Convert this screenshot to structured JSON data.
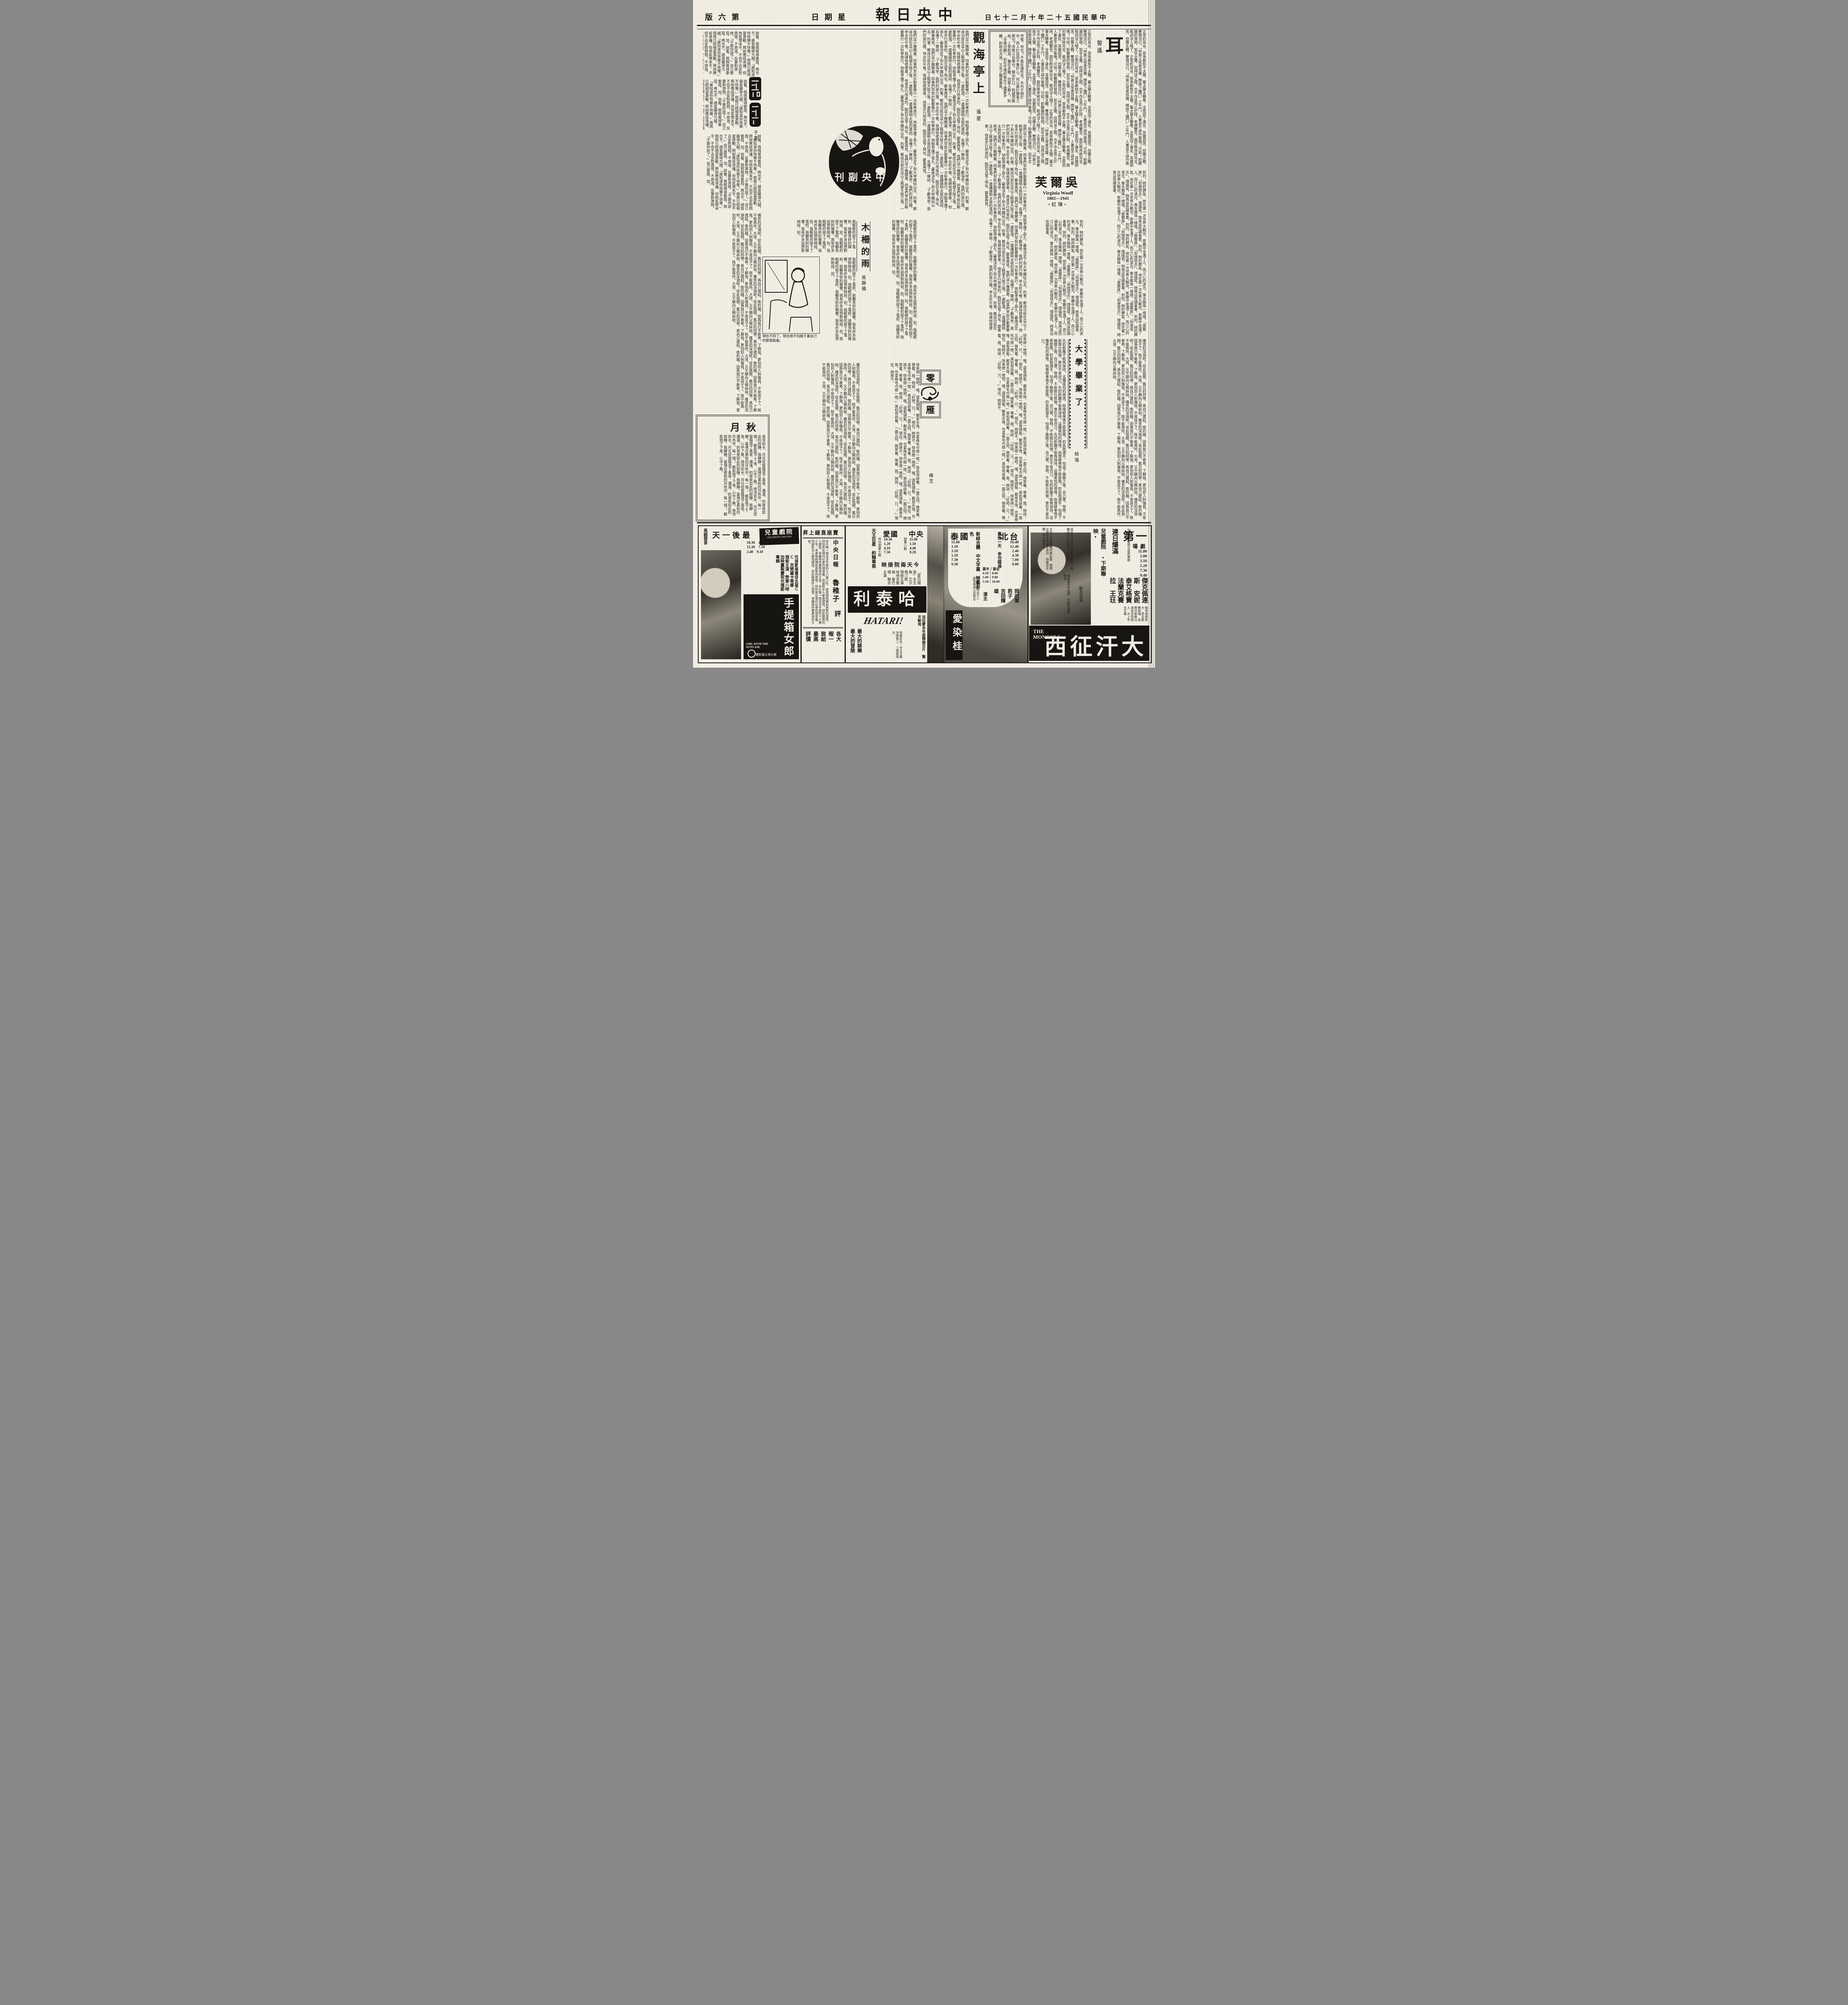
{
  "page": {
    "masthead_rtl": "報日央中",
    "date_rtl": "日七十二月十年二十五國民華中",
    "weekday_rtl": "日期星",
    "edition_rtl": "版六第",
    "paper_color": "#f2eee4",
    "ink_color": "#1b1813"
  },
  "supplement": {
    "logo_rtl": "刊副央中"
  },
  "articles": {
    "ear": {
      "title": "耳",
      "byline": "誓遙",
      "quote": [
        "然者，何也？不能反諸性也。夫內不開於中，而入於耳而不著於心，何以異於聾者之歌也？",
        "而無以自樂也。聲出於口，則越而散矣。",
        "上帝配耳，雖在多聽。但聖人教人，則「非禮勿聽」。",
        "如在守禮的條件下儘量多聽，則既合天道，又合之職責盡矣。"
      ],
      "body": [
        "正常的耳朵，原來都既不太聾，屬太聾太聽奢，全是因了違反。",
        "耳聾固苦，但聾太聽，雙情況已。",
        "「仲甚父常患耳聾，聞牀下蟻鬥」之牛鬥，人書豈不誤作雷鳴？可知！",
        "助聽器的發明，如非全聾，但拜送之間，也不作丞而止於拜。",
        "老病雙至，面的秩序將完全，歌詞沒人唱了。"
      ]
    },
    "guanhaiting": {
      "title": "觀海亭上",
      "byline": "遙星",
      "body": [
        "我們這小機關裏，同事們早就計劃要舉行一次秋季旅行，地點爭議了很久，最後決定了到大甲鐵砧山去。",
        "的事，鄭成功就在這山上眺望大陸之後，一邊飲酒，一邊誦讀明太祖的遺訓，長嘆了一聲說：「",
        "了觀海亭，我們的旅行團。",
        "甲去吃午餐，我請他搭便車。",
        "，他是步行而來的，臨別互留了地址，鄭重再見。"
      ]
    },
    "woolf": {
      "title_rtl": "芙爾吳",
      "latin_name": "Virginia Woolf",
      "years": "1882—1941",
      "byline_rtl": "•虹陳•",
      "body": [
        "到的，她的脾氣，他在第一次世界大戰完。",
        "客廳中坐滿了人，而江心的波光，像水銀珠一樣煌。",
        "「奧蘭度」、「到燈塔去」。",
        "理描寫。她爲這些讀者羣。"
      ]
    },
    "muzha": {
      "title": "木柵的雨",
      "byline": "吳靜儀",
      "body": [
        "我輕輕的按下了電鈴，我聽見鈴的聲響。",
        "我有許多話想對她說，別。"
      ],
      "illustration_caption": "現在不同了，現在她不怕鏡子裏自己的那張臉龐。"
    },
    "graduation": {
      "title": "大學畢業了",
      "byline": "給強",
      "body": [
        "先的距離不能再保持。這種害怕的感情，始懷疑事情不那麼簡。",
        "的長跑選手，怕過了幾圈之後，自己便。",
        "發椅，不能致仕就做。",
        "實在不是自己。"
      ]
    },
    "lingyan": {
      "title_top": "零",
      "title_bottom": "雁",
      "byline": "樟芝",
      "body": [
        "快來擦一擦吧，哦，還有頭髮，都是水珠，也拿條毛巾擦一擦。",
        "」吳伯母說着，一面又招。",
        "微笑着，等着，我。",
        "她說：「好吧，只。",
        "！」現在，她將不。"
      ]
    },
    "qiuyue": {
      "title_rtl": "月秋",
      "body": [
        "夜涼如水。",
        "月光從窗櫺瀉了進來，瀰滿。",
        "的夜是如此的寂靜，我靜靜。",
        "靈魂在柔和的月色中。每一個。",
        "，都鬆弛了下來，心中了無。"
      ]
    },
    "yuji": {
      "artist": "于吉",
      "body": [
        "說着，佩佩覺得委屈，再也不。",
        "語音顯得亢越。",
        "「誰知道你快樂不快樂。」",
        "佩佩已經相當激動，照說應該退讓。",
        "但他氣憤未平，不但不去安慰佩佩，不放過，反要刺激她。",
        "「不跟你說了。」自己委屈，加。"
      ]
    },
    "misc": {
      "body": [
        "痛苦的深淵呢！從此我開。",
        "舊日的同學，爲自己建起。",
        "衛的牆，因爲我已不敢希。",
        "了解我，更怕別人刺傷我。",
        "不是孩子了，既不能爲所。",
        "大哭，又不願向父親訴說。"
      ]
    }
  },
  "ads": {
    "children_theatre": {
      "name": "兒童戲院",
      "name_latin": "CHILDREN'S THEATRE",
      "last_day_rtl": "天一後最",
      "language": "英語發音",
      "times": [
        "10.30",
        "12.30",
        "2.40",
        "4.50",
        "7.10",
        "9.10"
      ],
      "cast_note": "坎城影展最佳女星ＣＣ　克勞黛卡蒂娜　領銜主演",
      "bonus_note": "勞軍八時加映臺製慶祝光復節專輯",
      "title": "手提箱女郎",
      "title_latin": "GIRL WITH THE SUITCASE",
      "award": "獲影壇五項大獎"
    },
    "review_box": {
      "header_rtl": "昇上線直座賣",
      "source": "中央日報",
      "critic": "魯稚子",
      "verb": "評",
      "body": [
        "本片藉一個未涉世故的十六歲少年，來表現純樸和眞摯的感情，特別是在現代社會的環境裏，",
        "到處對女人都是誘惑，因此醇厚的人間愛，是編導所要表達的主旨。"
      ],
      "footer": "各大報一致給最高評價"
    },
    "hatari": {
      "theater_a": "中央",
      "theater_a_times": [
        "11.00",
        "1.50",
        "4.40",
        "8.20"
      ],
      "theater_a_note": "勞軍八點",
      "theater_b": "愛國",
      "theater_b_times": [
        "10.30",
        "1.20",
        "4.10",
        "7.50"
      ],
      "theater_b_note": "卅分勞軍七點",
      "relay_rtl": "映接院兩天今",
      "star_billing": "天王巨星　約翰韋恩",
      "costar_billing": "「夏日烟雲」女主角　艾沙瑪汀妮　領銜主演",
      "costars": "哈地克魯格　雷巴頓　聯合主演",
      "title_rtl": "利泰哈",
      "title_latin": "HATARI!",
      "studio_note": "派拉蒙本年度輝煌巨片　驚天動地",
      "format_note": "特藝彩色・中文字幕",
      "slogan": "最大的娛樂　最大的冒險",
      "newsreel_note": "加映第二、三號新聞片"
    },
    "aizenkatsura": {
      "theater_a_rtl": "北台",
      "theater_a_times": [
        "10.40",
        "12.40",
        "2.40",
        "4.30",
        "7.00",
        "9.00"
      ],
      "last_day": "最後一天　幸勿錯過",
      "theater_b_rtl": "泰國",
      "theater_b_times": [
        "11.00",
        "1.10",
        "3.10",
        "5.10",
        "7.30",
        "9.30"
      ],
      "format_note": "新綜合體　中文字幕　特藝彩色",
      "ticket_full_label_rtl": "票全",
      "ticket_half_label_rtl": "票半",
      "ticket_full": [
        "8.00",
        "9.00",
        "10.00"
      ],
      "ticket_half": [
        "4.50",
        "5.00",
        "5.50"
      ],
      "cast": "岡田茉莉子　吉田輝雄",
      "cast_role_rtl": "演主",
      "tagline": "世界三大情史之一　劇情勝過山伯英台",
      "title": "愛染桂"
    },
    "first_theatre": {
      "name_big_rtl": "第一",
      "name_small_rtl": "場劇",
      "times": [
        "11.00",
        "1.00",
        "3.10",
        "5.20",
        "7.30",
        "9.40"
      ],
      "bonus_note": "加映臺製慶祝光復節專輯",
      "full_house": "連日爆滿",
      "next_venue": "兒童戲院　•下期聯映•",
      "stars": [
        "傑克佩連斯",
        "安妮泰艾格寶",
        "法蘭克賽拉",
        "王玨"
      ],
      "stars_role": "聯合主演",
      "tags": [
        "戰爭場面奇大",
        "蒙古藍舞銷魂",
        "故事可歌無泣",
        "演技深刻感人",
        "片上中文字幕"
      ],
      "blurbs_right": "成吉思汗遠征歐陸動人故事　美義合作六百萬美元名片",
      "blurbs_left": "大可汗德威彙備四夷臣服　窩闊台雄才大略盡世武功　特藝綜合體　伊士曼彩色",
      "blurbs_bottom": "雄旗蔽天甲如雲　大軍西進威異域",
      "title_latin": "THE MONGOLS",
      "title_rtl": "西征汗大"
    }
  }
}
